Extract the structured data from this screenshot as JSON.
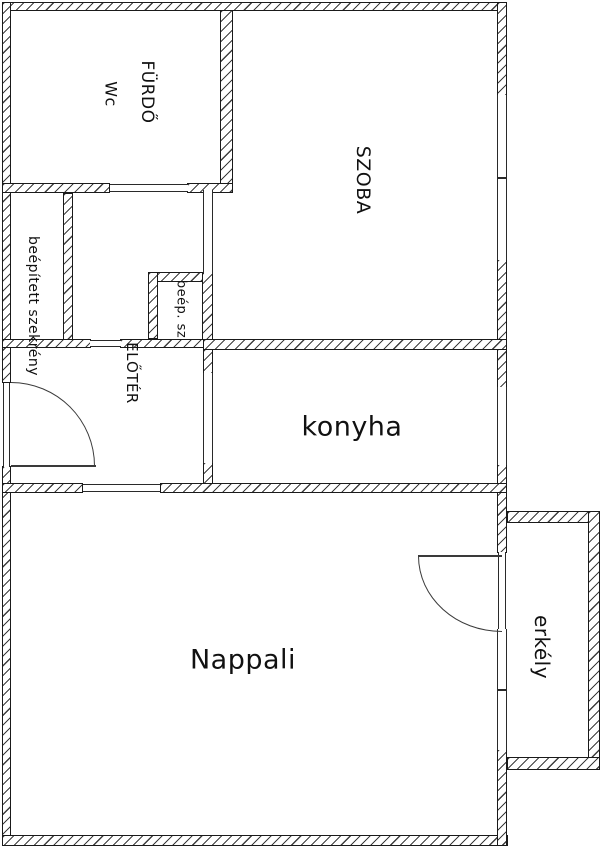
{
  "title": "Apartment floor plan",
  "colors": {
    "line": "#1a1a1a",
    "hatch": "#3d3d3d",
    "background": "#ffffff",
    "text": "#111111"
  },
  "rooms": {
    "furdo": {
      "label": "FÜRDŐ"
    },
    "wc": {
      "label": "Wc"
    },
    "szoba": {
      "label": "SZOBA"
    },
    "beepitett": {
      "label": "beépített szekrény"
    },
    "beep_sz": {
      "label": "beép. sz"
    },
    "eloter": {
      "label": "ELŐTÉR"
    },
    "konyha": {
      "label": "konyha"
    },
    "nappali": {
      "label": "Nappali"
    },
    "erkely": {
      "label": "erkély"
    }
  },
  "plan": {
    "width": 600,
    "height": 847,
    "walls": [
      [
        2,
        2,
        505,
        9
      ],
      [
        2,
        2,
        9,
        381
      ],
      [
        2,
        466,
        9,
        370
      ],
      [
        2,
        835,
        506,
        11
      ],
      [
        497,
        2,
        10,
        94
      ],
      [
        497,
        259,
        10,
        129
      ],
      [
        497,
        464,
        10,
        89
      ],
      [
        497,
        749,
        10,
        97
      ],
      [
        2,
        183,
        108,
        10
      ],
      [
        187,
        183,
        46,
        10
      ],
      [
        220,
        10,
        13,
        174
      ],
      [
        63,
        193,
        10,
        147
      ],
      [
        2,
        339,
        89,
        9
      ],
      [
        120,
        339,
        93,
        9
      ],
      [
        148,
        272,
        64,
        10
      ],
      [
        148,
        272,
        10,
        67
      ],
      [
        202,
        272,
        11,
        68
      ],
      [
        203,
        339,
        304,
        11
      ],
      [
        203,
        349,
        10,
        25
      ],
      [
        203,
        462,
        10,
        22
      ],
      [
        2,
        483,
        81,
        10
      ],
      [
        160,
        483,
        347,
        10
      ],
      [
        507,
        511,
        93,
        12
      ],
      [
        588,
        511,
        12,
        259
      ],
      [
        507,
        757,
        93,
        13
      ]
    ],
    "openings": [
      [
        110,
        184,
        78,
        8,
        "h",
        "furdo-door-opening"
      ],
      [
        203,
        190,
        10,
        84,
        "v",
        "szoba-door-opening"
      ],
      [
        203,
        373,
        10,
        90,
        "v",
        "konyha-door-opening"
      ],
      [
        83,
        484,
        77,
        8,
        "h",
        "eloter-nappali-opening"
      ],
      [
        90,
        340,
        31,
        7,
        "h",
        "closet-niche-opening"
      ],
      [
        497,
        95,
        10,
        165,
        "v",
        "szoba-window"
      ],
      [
        497,
        387,
        10,
        78,
        "v",
        "konyha-window"
      ],
      [
        498,
        552,
        8,
        80,
        "v",
        "balcony-door-opening"
      ],
      [
        497,
        629,
        10,
        121,
        "v",
        "nappali-window"
      ],
      [
        3,
        383,
        7,
        84,
        "v",
        "entrance-door-opening"
      ]
    ],
    "ticks": [
      [
        497,
        177,
        10,
        2
      ],
      [
        497,
        689,
        10,
        2
      ]
    ],
    "arcs": [
      {
        "x": 11,
        "y": 382,
        "w": 84,
        "h": 84,
        "dir": "ne",
        "name": "entrance-door-arc"
      },
      {
        "x": 418,
        "y": 556,
        "w": 84,
        "h": 76,
        "dir": "sw",
        "name": "balcony-door-arc"
      }
    ],
    "leaves": [
      [
        11,
        465,
        85,
        2,
        "entrance-door-leaf"
      ],
      [
        418,
        555,
        84,
        2,
        "balcony-door-leaf"
      ]
    ],
    "labels": [
      {
        "room": "furdo",
        "x": 147,
        "y": 92,
        "rot": true,
        "size": 17
      },
      {
        "room": "wc",
        "x": 111,
        "y": 94,
        "rot": true,
        "size": 16
      },
      {
        "room": "szoba",
        "x": 363,
        "y": 180,
        "rot": true,
        "size": 19
      },
      {
        "room": "beepitett",
        "x": 33,
        "y": 306,
        "rot": true,
        "size": 14
      },
      {
        "room": "beep_sz",
        "x": 181,
        "y": 309,
        "rot": true,
        "size": 13
      },
      {
        "room": "eloter",
        "x": 132,
        "y": 373,
        "rot": true,
        "size": 15
      },
      {
        "room": "konyha",
        "x": 352,
        "y": 427,
        "rot": false,
        "size": 27
      },
      {
        "room": "nappali",
        "x": 243,
        "y": 660,
        "rot": false,
        "size": 27
      },
      {
        "room": "erkely",
        "x": 542,
        "y": 647,
        "rot": true,
        "size": 20
      }
    ]
  }
}
